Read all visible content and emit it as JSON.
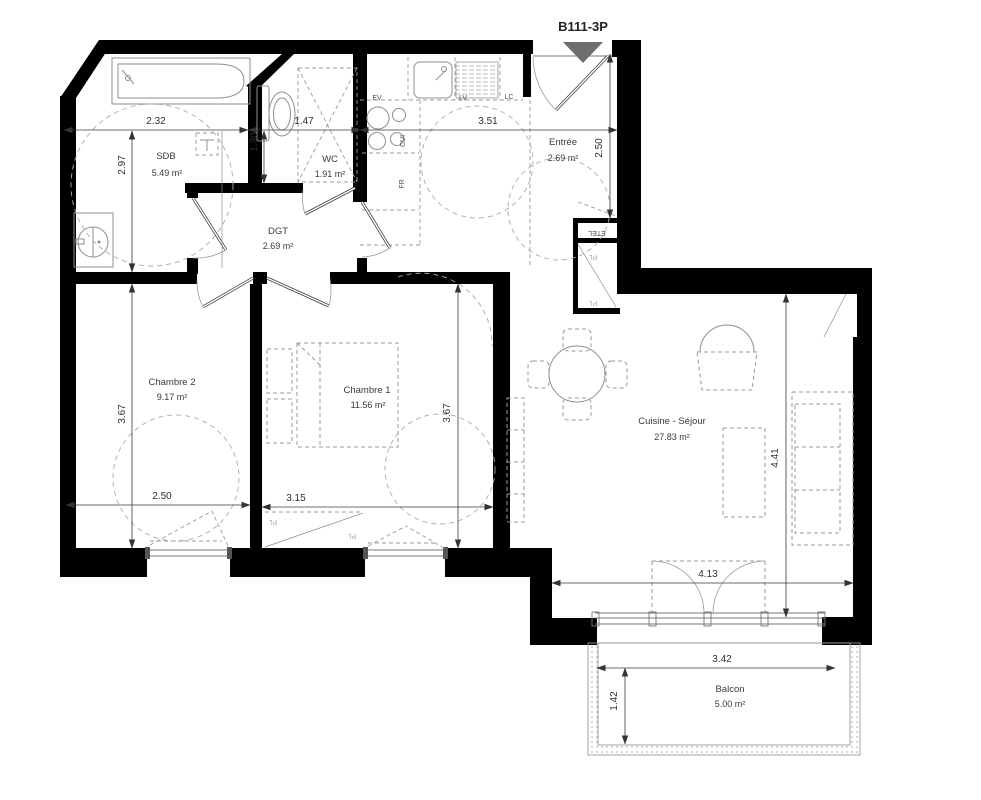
{
  "title": "B111-3P",
  "rooms": [
    {
      "id": "sdb",
      "name": "SDB",
      "area": "5.49 m²"
    },
    {
      "id": "wc",
      "name": "WC",
      "area": "1.91 m²"
    },
    {
      "id": "dgt",
      "name": "DGT",
      "area": "2.69 m²"
    },
    {
      "id": "entree",
      "name": "Entrée",
      "area": "2.69 m²"
    },
    {
      "id": "chambre2",
      "name": "Chambre 2",
      "area": "9.17 m²"
    },
    {
      "id": "chambre1",
      "name": "Chambre 1",
      "area": "11.56 m²"
    },
    {
      "id": "sejour",
      "name": "Cuisine - Séjour",
      "area": "27.83 m²"
    },
    {
      "id": "balcon",
      "name": "Balcon",
      "area": "5.00 m²"
    }
  ],
  "dimensions": {
    "sdb_width": "2.32",
    "sdb_height": "2.97",
    "wc_width": "1.47",
    "wc_height": "1.30",
    "cuisine_width": "3.51",
    "entree_height": "2.50",
    "chambre2_width": "2.50",
    "chambre2_height": "3.67",
    "chambre1_width": "3.15",
    "chambre1_height": "3.67",
    "sejour_width": "4.13",
    "sejour_height": "4.41",
    "balcon_width": "3.42",
    "balcon_height": "1.42"
  },
  "equipment_labels": {
    "ev": "EV",
    "lv": "LV",
    "lc": "LC",
    "cui": "CUI",
    "fr": "FR",
    "etel": "ETEL",
    "pl": "PL"
  },
  "colors": {
    "wall": "#000000",
    "entrance_marker": "#6e6e6e",
    "closet_label": "#8ab6d8",
    "dimension_text": "#2e2e2e"
  }
}
